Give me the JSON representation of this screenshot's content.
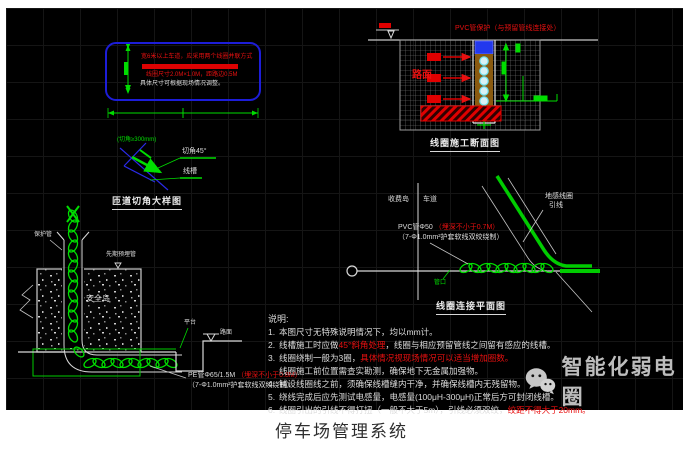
{
  "page": {
    "caption": "停车场管理系统"
  },
  "watermark": {
    "brand": "智能化弱电圈",
    "icon": "wechat-icon"
  },
  "colors": {
    "cad_green": "#00dd00",
    "cad_red": "#e81010",
    "cad_blue": "#1d1dd8",
    "cad_white": "#dedede",
    "watermark_gray": "#bdbdbd"
  },
  "loop_box": {
    "line1": "宽6米以上车道，应采用两个线圈并联方式",
    "line3": "线圈尺寸2.0M×1.0M，距路边0.5M",
    "line4": "具体尺寸可根据现场情况调整。"
  },
  "ramp_detail": {
    "dim_note": "(切角≥300mm)",
    "label_cut": "切角45°",
    "label_slot": "线槽",
    "caption": "匝道切角大样图"
  },
  "section": {
    "top_note": "PVC管保护（与预留管线连接处）",
    "road_label": "路面",
    "caption": "线圈施工断面图"
  },
  "plan": {
    "header_left": "收费岛",
    "header_right": "车道",
    "lead_label_1": "地感线圈",
    "lead_label_2": "引线",
    "spec_white_1": "PVC管Φ50 ",
    "spec_red_1": "（埋深不小于0.7M）",
    "spec_line2": "（7-Φ1.0mm²护套软线双绞绕制）",
    "port_label": "管口",
    "caption": "线圈连接平面图"
  },
  "island_detail": {
    "pipe_label": "保护管",
    "embed_label": "先期预埋管",
    "island_label": "安全岛",
    "platform_label": "平台",
    "road_label": "路面",
    "spec_white_1": "PE管Φ65/1.5M ",
    "spec_red_1": "（埋深不小于0.8M）",
    "spec_line2": "（7-Φ1.0mm²护套软线双绞绕制）"
  },
  "notes": {
    "title": "说明:",
    "items": [
      {
        "no": "1.",
        "pre": "本图尺寸无特殊说明情况下，均以mm计。",
        "red": "",
        "post": ""
      },
      {
        "no": "2.",
        "pre": "线槽施工时应做",
        "red": "45°斜角处理",
        "post": "，线圈与相应预留管线之间留有感应的线槽。"
      },
      {
        "no": "3.",
        "pre": "线圈绕制一般为3圈，",
        "red": "具体情况视现场情况可以适当增加圈数。",
        "post": ""
      },
      {
        "no": "",
        "pre": "线圈施工前位置需查实勘测，确保地下无金属加强物。",
        "red": "",
        "post": ""
      },
      {
        "no": "4.",
        "pre": "铺设线圈线之前，须确保线槽缝内干净，并确保线槽内无残留物。",
        "red": "",
        "post": ""
      },
      {
        "no": "5.",
        "pre": "绕线完成后应先测试电感量，电感量(100μH-300μH)正常后方可封闭线槽。",
        "red": "",
        "post": ""
      },
      {
        "no": "6.",
        "pre": "线圈引出的引线不得打扭（一般不大于5m），引线必须双绞，",
        "red": "绞距不得大于20mm。",
        "post": ""
      }
    ]
  }
}
